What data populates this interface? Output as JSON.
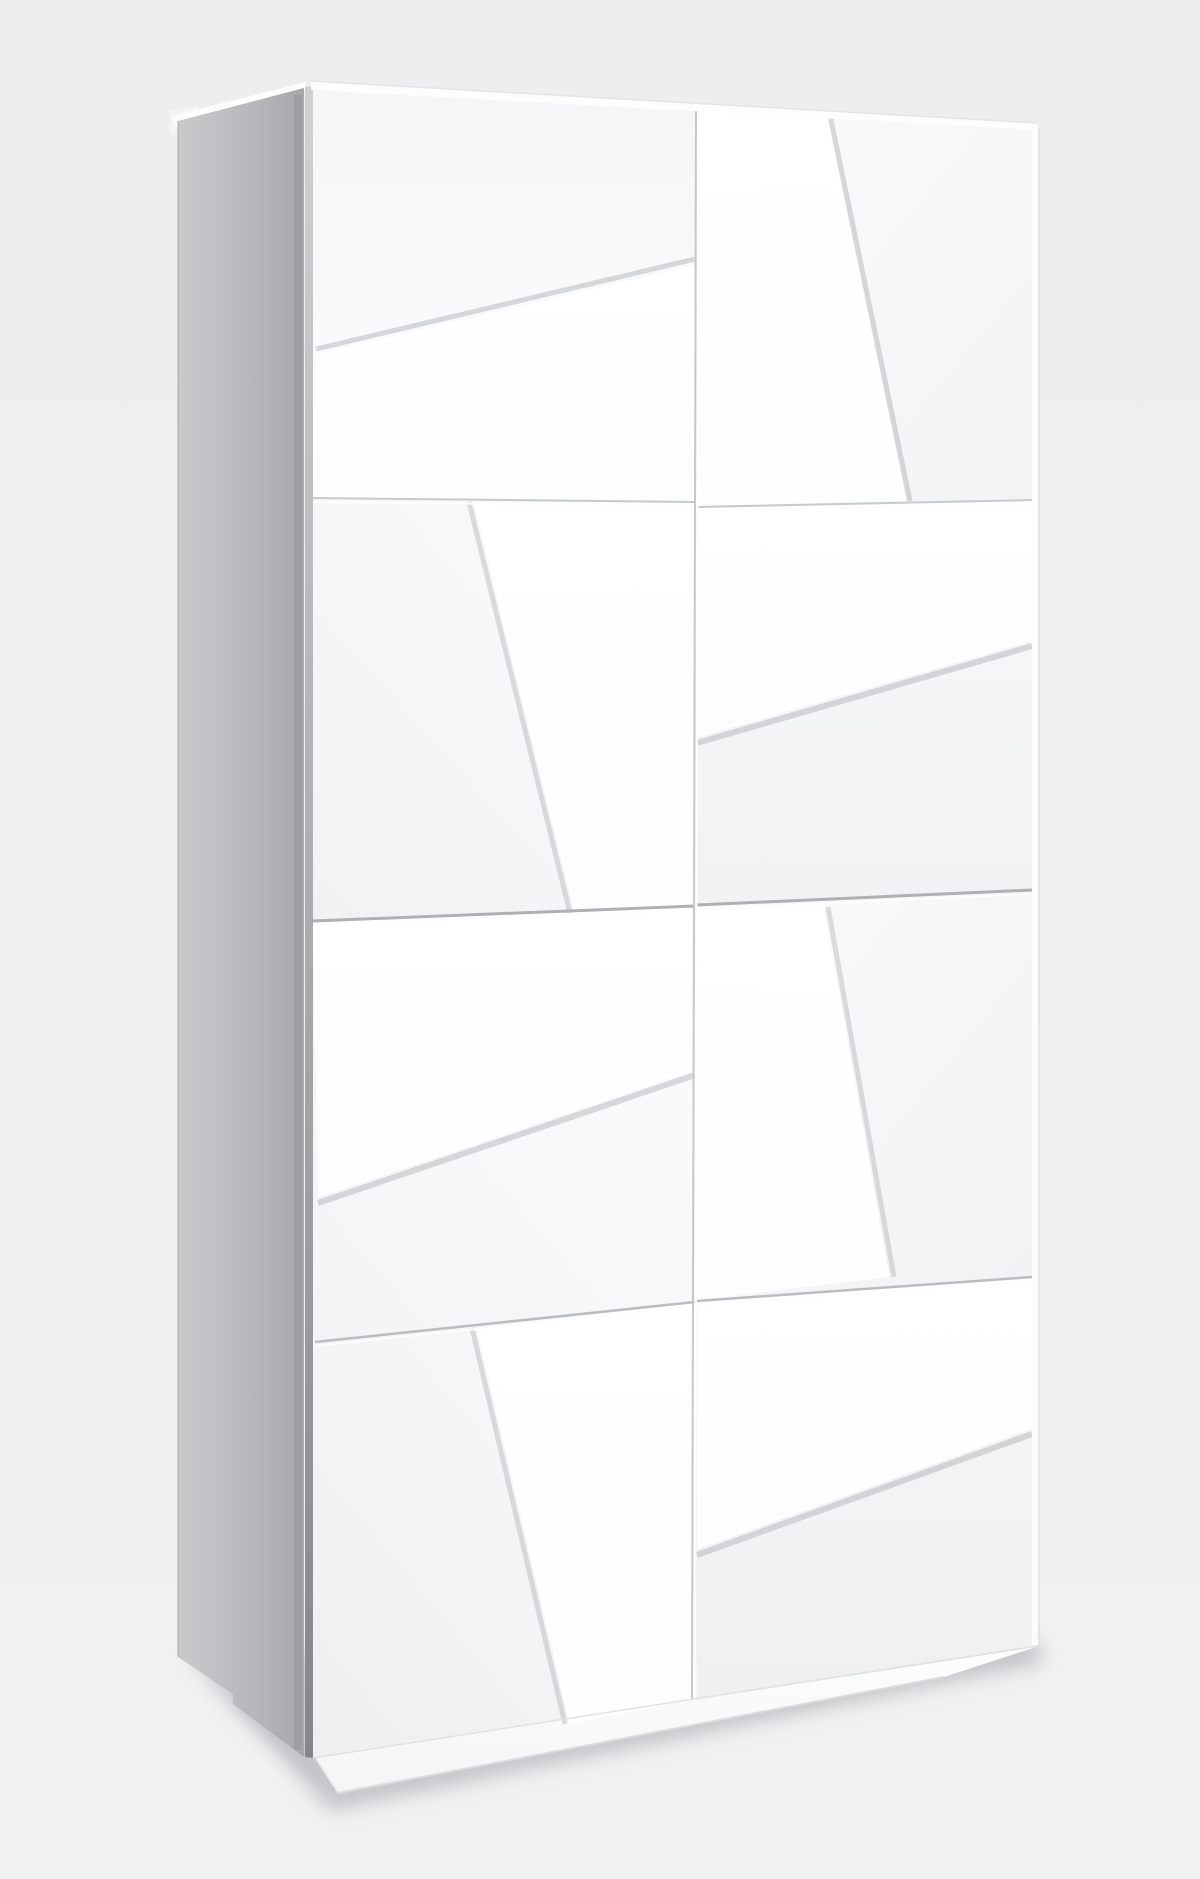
{
  "scene": {
    "description": "Three-quarter studio render of a tall white wardrobe with angled 3D facet door panels, gray left side panel, recessed plinth and soft floor shadow",
    "viewbox": "0 0 1200 1879",
    "palette": {
      "background_top": "#eceef0",
      "background_bottom": "#f0f1f2",
      "side_panel_back": "#c9cacc",
      "side_panel_front": "#a6a7aa",
      "door_face": "#f5f6f8",
      "raised_panel": "#ffffff",
      "seam_line_strong": "#aeb0b4",
      "seam_line_light": "#c8c9cc",
      "shadow_gray": "rgba(148,151,156,0.40)"
    },
    "filters": [
      {
        "id": "soft",
        "blur": 9
      }
    ],
    "gradients": [
      {
        "id": "gBg",
        "x1": 0,
        "y1": 0,
        "x2": 0,
        "y2": 1,
        "stops": [
          [
            0,
            "#eceef0"
          ],
          [
            1,
            "#f0f1f2"
          ]
        ]
      },
      {
        "id": "gSide",
        "x1": 0,
        "y1": 0,
        "x2": 1,
        "y2": 0,
        "stops": [
          [
            0,
            "#c9cacc"
          ],
          [
            0.55,
            "#b8b9bc"
          ],
          [
            1,
            "#a6a7aa"
          ]
        ]
      },
      {
        "id": "gSliver",
        "x1": 0,
        "y1": 0,
        "x2": 0,
        "y2": 1,
        "stops": [
          [
            0,
            "#d0d1d3"
          ],
          [
            1,
            "#85868a"
          ]
        ]
      },
      {
        "id": "gPanel",
        "x1": 0,
        "y1": 0,
        "x2": 0,
        "y2": 1,
        "stops": [
          [
            0,
            "#ffffff"
          ],
          [
            1,
            "#fcfdfd"
          ]
        ]
      },
      {
        "id": "gF1L",
        "x1": 0,
        "y1": 0,
        "x2": 0,
        "y2": 1,
        "stops": [
          [
            0,
            "#f5f6f8"
          ],
          [
            1,
            "#fbfcfd"
          ]
        ]
      },
      {
        "id": "gF1R",
        "x1": 0,
        "y1": 0,
        "x2": 1,
        "y2": 1,
        "stops": [
          [
            0,
            "#fafbfc"
          ],
          [
            1,
            "#f2f3f5"
          ]
        ]
      },
      {
        "id": "gF2L",
        "x1": 1,
        "y1": 0,
        "x2": 0,
        "y2": 1,
        "stops": [
          [
            0,
            "#fafbfc"
          ],
          [
            1,
            "#f1f2f4"
          ]
        ]
      },
      {
        "id": "gF2R",
        "x1": 0,
        "y1": 0,
        "x2": 0,
        "y2": 1,
        "stops": [
          [
            0,
            "#f7f8f9"
          ],
          [
            1,
            "#f1f2f4"
          ]
        ]
      },
      {
        "id": "gF3L",
        "x1": 1,
        "y1": 0,
        "x2": 0,
        "y2": 1,
        "stops": [
          [
            0,
            "#fbfcfd"
          ],
          [
            1,
            "#f3f4f6"
          ]
        ]
      },
      {
        "id": "gF3R",
        "x1": 0,
        "y1": 0,
        "x2": 1,
        "y2": 1,
        "stops": [
          [
            0,
            "#f9fafb"
          ],
          [
            1,
            "#f1f2f4"
          ]
        ]
      },
      {
        "id": "gF4L",
        "x1": 1,
        "y1": 0,
        "x2": 0,
        "y2": 1,
        "stops": [
          [
            0,
            "#f9fafb"
          ],
          [
            1,
            "#edeff1"
          ]
        ]
      },
      {
        "id": "gF4R",
        "x1": 0,
        "y1": 0,
        "x2": 0,
        "y2": 1,
        "stops": [
          [
            0,
            "#f5f6f7"
          ],
          [
            1,
            "#eff0f2"
          ]
        ]
      },
      {
        "id": "gPlinth",
        "x1": 0,
        "y1": 0,
        "x2": 0,
        "y2": 1,
        "stops": [
          [
            0,
            "#fcfdfd"
          ],
          [
            1,
            "#f4f5f6"
          ]
        ]
      }
    ],
    "shapes": [
      {
        "name": "backdrop",
        "type": "rect",
        "x": 0,
        "y": 0,
        "w": 1200,
        "h": 1879,
        "fill": "url(#gBg)"
      },
      {
        "name": "floor-shadow-main",
        "type": "polygon",
        "filter": "soft",
        "fill": "rgba(148,151,156,0.40)",
        "points": "188,1652 1038,1638 1042,1664 330,1812"
      },
      {
        "name": "floor-shadow-corner",
        "type": "polygon",
        "filter": "soft",
        "fill": "rgba(118,120,125,0.28)",
        "points": "196,1658 320,1770 345,1802 240,1712"
      },
      {
        "name": "floor-shadow-contact",
        "type": "line",
        "filter": "soft",
        "x1": 340,
        "y1": 1794,
        "x2": 1034,
        "y2": 1652,
        "stroke": "rgba(140,143,148,0.30)",
        "width": 6
      },
      {
        "name": "top-slab-back-step",
        "type": "polygon",
        "fill": "#f3f4f5",
        "points": "170,111 198,105 198,128 170,134"
      },
      {
        "name": "top-slab-side-strip",
        "type": "polygon",
        "fill": "#fbfcfc",
        "points": "171,116 306,82 306,91 177,127"
      },
      {
        "name": "side-panel",
        "type": "polygon",
        "fill": "url(#gSide)",
        "points": "178,121 304,88 304,1757 233,1704 233,1694 178,1657"
      },
      {
        "name": "side-panel-ao-line",
        "type": "line",
        "x1": 298,
        "y1": 95,
        "x2": 298,
        "y2": 1750,
        "stroke": "rgba(70,72,76,0.10)",
        "width": 8
      },
      {
        "name": "side-panel-back-edge",
        "type": "line",
        "x1": 178,
        "y1": 121,
        "x2": 178,
        "y2": 1657,
        "stroke": "rgba(120,122,126,0.35)",
        "width": 1.5
      },
      {
        "name": "front-left-reveal-sliver",
        "type": "polygon",
        "fill": "url(#gSliver)",
        "points": "305,87 313,86 313,1758 305,1757"
      },
      {
        "name": "carcass-front-base",
        "type": "polygon",
        "fill": "#f4f5f7",
        "points": "313,86 1036,128 1036,1646 313,1758"
      },
      {
        "name": "plinth-strip",
        "type": "polygon",
        "fill": "url(#gPlinth)",
        "points": "316,1758 1036,1647 944,1677 338,1794"
      },
      {
        "name": "plinth-bottom-edge",
        "type": "line",
        "x1": 338,
        "y1": 1793,
        "x2": 944,
        "y2": 1677,
        "stroke": "#d9dbdd",
        "width": 2
      },
      {
        "name": "plinth-left-step-edge",
        "type": "line",
        "x1": 338,
        "y1": 1793,
        "x2": 316,
        "y2": 1759,
        "stroke": "#e3e4e6",
        "width": 1.5
      },
      {
        "name": "door-face-upper-left",
        "type": "polygon",
        "fill": "url(#gF1L)",
        "points": "313,87 695,109 695,502 313,498"
      },
      {
        "name": "door-face-upper-right",
        "type": "polygon",
        "fill": "url(#gF1R)",
        "points": "697,106 1032,128 1032,500 697,507"
      },
      {
        "name": "door-face-mid-left",
        "type": "polygon",
        "fill": "url(#gF2L)",
        "points": "313,498 695,502 695,906 313,921"
      },
      {
        "name": "door-face-mid-right",
        "type": "polygon",
        "fill": "url(#gF2R)",
        "points": "697,507 1032,500 1032,890 697,905"
      },
      {
        "name": "door-face-lower-left",
        "type": "polygon",
        "fill": "url(#gF3L)",
        "points": "313,921 695,906 695,1302 315,1342"
      },
      {
        "name": "door-face-lower-right",
        "type": "polygon",
        "fill": "url(#gF3R)",
        "points": "697,905 1032,890 1032,1277 697,1301"
      },
      {
        "name": "door-face-bottom-left",
        "type": "polygon",
        "fill": "url(#gF4L)",
        "points": "315,1342 695,1302 695,1700 313,1758"
      },
      {
        "name": "door-face-bottom-right",
        "type": "polygon",
        "fill": "url(#gF4R)",
        "points": "697,1301 1032,1277 1032,1646 697,1700"
      },
      {
        "name": "facet-panel-wedge-upper-left",
        "type": "polygon",
        "fill": "url(#gPanel)",
        "points": "316,355 695,265 695,502 313,498"
      },
      {
        "name": "facet-panel-steep-upper-right",
        "type": "polygon",
        "fill": "url(#gPanel)",
        "points": "697,106 826,114 906,501 697,506"
      },
      {
        "name": "facet-panel-steep-mid-left",
        "type": "polygon",
        "fill": "url(#gPanel)",
        "points": "474,502 695,503 695,908 575,914"
      },
      {
        "name": "facet-panel-band-mid-right",
        "type": "polygon",
        "fill": "url(#gPanel)",
        "points": "697,508 1032,501 1032,640 697,737"
      },
      {
        "name": "facet-panel-wedge-lower-left",
        "type": "polygon",
        "fill": "url(#gPanel)",
        "points": "313,922 695,907 695,1069 318,1197"
      },
      {
        "name": "facet-panel-steep-lower-right",
        "type": "polygon",
        "fill": "url(#gPanel)",
        "points": "697,906 823,905 889,1277 697,1300"
      },
      {
        "name": "facet-panel-steep-bottom-left",
        "type": "polygon",
        "fill": "url(#gPanel)",
        "points": "477,1328 695,1303 695,1699 570,1724"
      },
      {
        "name": "facet-panel-band-bottom-right",
        "type": "polygon",
        "fill": "url(#gPanel)",
        "points": "697,1302 1032,1278 1032,1428 697,1549"
      },
      {
        "name": "facet-shadow-upper-left",
        "type": "line",
        "x1": 316,
        "y1": 349,
        "x2": 695,
        "y2": 259,
        "stroke": "rgba(170,173,178,0.45)",
        "width": 5
      },
      {
        "name": "facet-edge-upper-left",
        "type": "line",
        "x1": 316,
        "y1": 356,
        "x2": 695,
        "y2": 266,
        "stroke": "#ffffff",
        "width": 2.5
      },
      {
        "name": "facet-shadow-upper-right",
        "type": "line",
        "x1": 830,
        "y1": 115,
        "x2": 910,
        "y2": 501,
        "stroke": "rgba(170,173,178,0.45)",
        "width": 5
      },
      {
        "name": "facet-edge-upper-right",
        "type": "line",
        "x1": 825,
        "y1": 114,
        "x2": 905,
        "y2": 501,
        "stroke": "#ffffff",
        "width": 2.5
      },
      {
        "name": "facet-shadow-mid-left",
        "type": "line",
        "x1": 469,
        "y1": 502,
        "x2": 570,
        "y2": 913,
        "stroke": "rgba(170,173,178,0.40)",
        "width": 5
      },
      {
        "name": "facet-edge-mid-left",
        "type": "line",
        "x1": 475,
        "y1": 502,
        "x2": 576,
        "y2": 913,
        "stroke": "#ffffff",
        "width": 2.5
      },
      {
        "name": "facet-shadow-mid-right",
        "type": "line",
        "x1": 697,
        "y1": 743,
        "x2": 1032,
        "y2": 646,
        "stroke": "rgba(170,173,178,0.45)",
        "width": 6
      },
      {
        "name": "facet-edge-mid-right",
        "type": "line",
        "x1": 697,
        "y1": 736,
        "x2": 1032,
        "y2": 639,
        "stroke": "#ffffff",
        "width": 2.5
      },
      {
        "name": "facet-shadow-lower-left",
        "type": "line",
        "x1": 318,
        "y1": 1203,
        "x2": 695,
        "y2": 1075,
        "stroke": "rgba(170,173,178,0.45)",
        "width": 6
      },
      {
        "name": "facet-edge-lower-left",
        "type": "line",
        "x1": 318,
        "y1": 1196,
        "x2": 695,
        "y2": 1068,
        "stroke": "#ffffff",
        "width": 2.5
      },
      {
        "name": "facet-shadow-lower-right",
        "type": "line",
        "x1": 828,
        "y1": 907,
        "x2": 894,
        "y2": 1277,
        "stroke": "rgba(170,173,178,0.40)",
        "width": 5
      },
      {
        "name": "facet-edge-lower-right",
        "type": "line",
        "x1": 822,
        "y1": 905,
        "x2": 888,
        "y2": 1277,
        "stroke": "#ffffff",
        "width": 2.5
      },
      {
        "name": "facet-shadow-bottom-left",
        "type": "line",
        "x1": 472,
        "y1": 1328,
        "x2": 565,
        "y2": 1724,
        "stroke": "rgba(170,173,178,0.40)",
        "width": 5
      },
      {
        "name": "facet-edge-bottom-left",
        "type": "line",
        "x1": 478,
        "y1": 1328,
        "x2": 571,
        "y2": 1724,
        "stroke": "#ffffff",
        "width": 2.5
      },
      {
        "name": "facet-shadow-bottom-right",
        "type": "line",
        "x1": 697,
        "y1": 1555,
        "x2": 1032,
        "y2": 1434,
        "stroke": "rgba(170,173,178,0.45)",
        "width": 6
      },
      {
        "name": "facet-edge-bottom-right",
        "type": "line",
        "x1": 697,
        "y1": 1548,
        "x2": 1032,
        "y2": 1427,
        "stroke": "#ffffff",
        "width": 2.5
      },
      {
        "name": "seam-1-left-shadow",
        "type": "line",
        "x1": 313,
        "y1": 498,
        "x2": 695,
        "y2": 502,
        "stroke": "#c8c9cc",
        "width": 2
      },
      {
        "name": "seam-1-left-light",
        "type": "line",
        "x1": 313,
        "y1": 502,
        "x2": 695,
        "y2": 506,
        "stroke": "#fdfdfe",
        "width": 2
      },
      {
        "name": "seam-1-right-shadow",
        "type": "line",
        "x1": 697,
        "y1": 507,
        "x2": 1032,
        "y2": 500,
        "stroke": "#c8c9cc",
        "width": 2
      },
      {
        "name": "seam-1-right-light",
        "type": "line",
        "x1": 697,
        "y1": 511,
        "x2": 1032,
        "y2": 504,
        "stroke": "#fdfdfe",
        "width": 2
      },
      {
        "name": "seam-2-left-shadow",
        "type": "line",
        "x1": 313,
        "y1": 921,
        "x2": 695,
        "y2": 906,
        "stroke": "#aeb0b4",
        "width": 3
      },
      {
        "name": "seam-2-left-light",
        "type": "line",
        "x1": 313,
        "y1": 925,
        "x2": 695,
        "y2": 910,
        "stroke": "#fcfdfd",
        "width": 2
      },
      {
        "name": "seam-2-right-shadow",
        "type": "line",
        "x1": 697,
        "y1": 905,
        "x2": 1032,
        "y2": 890,
        "stroke": "#aeb0b4",
        "width": 3
      },
      {
        "name": "seam-2-right-light",
        "type": "line",
        "x1": 697,
        "y1": 909,
        "x2": 1032,
        "y2": 894,
        "stroke": "#fcfdfd",
        "width": 2
      },
      {
        "name": "seam-3-left-shadow",
        "type": "line",
        "x1": 315,
        "y1": 1342,
        "x2": 695,
        "y2": 1302,
        "stroke": "#babcbf",
        "width": 2.5
      },
      {
        "name": "seam-3-left-light",
        "type": "line",
        "x1": 315,
        "y1": 1346,
        "x2": 695,
        "y2": 1306,
        "stroke": "#fcfdfd",
        "width": 2
      },
      {
        "name": "seam-3-right-shadow",
        "type": "line",
        "x1": 697,
        "y1": 1301,
        "x2": 1032,
        "y2": 1277,
        "stroke": "#babcbf",
        "width": 2.5
      },
      {
        "name": "seam-3-right-light",
        "type": "line",
        "x1": 697,
        "y1": 1305,
        "x2": 1032,
        "y2": 1281,
        "stroke": "#fcfdfd",
        "width": 2
      },
      {
        "name": "center-door-gap-shadow",
        "type": "line",
        "x1": 696,
        "y1": 107,
        "x2": 692,
        "y2": 1699,
        "stroke": "#c6c8ca",
        "width": 2
      },
      {
        "name": "center-door-gap-light",
        "type": "line",
        "x1": 698.5,
        "y1": 107,
        "x2": 694.5,
        "y2": 1699,
        "stroke": "rgba(255,255,255,0.9)",
        "width": 2
      },
      {
        "name": "right-carcass-edge-strip",
        "type": "polygon",
        "fill": "#fafbfc",
        "points": "1032,127 1039,128 1039,1645 1032,1646"
      },
      {
        "name": "right-carcass-outer-edge",
        "type": "line",
        "x1": 1039,
        "y1": 128,
        "x2": 1039,
        "y2": 1645,
        "stroke": "#dddfe1",
        "width": 1.5
      },
      {
        "name": "top-slab-front-strip",
        "type": "polygon",
        "fill": "#fcfdfd",
        "points": "311,81 1038,123 1038,130 311,90"
      },
      {
        "name": "top-front-edge",
        "type": "line",
        "x1": 311,
        "y1": 81,
        "x2": 1038,
        "y2": 123,
        "stroke": "#e1e3e5",
        "width": 1.5
      },
      {
        "name": "bottom-door-edge",
        "type": "line",
        "x1": 313,
        "y1": 1758,
        "x2": 1036,
        "y2": 1646,
        "stroke": "#e0e2e4",
        "width": 1.5
      }
    ]
  }
}
